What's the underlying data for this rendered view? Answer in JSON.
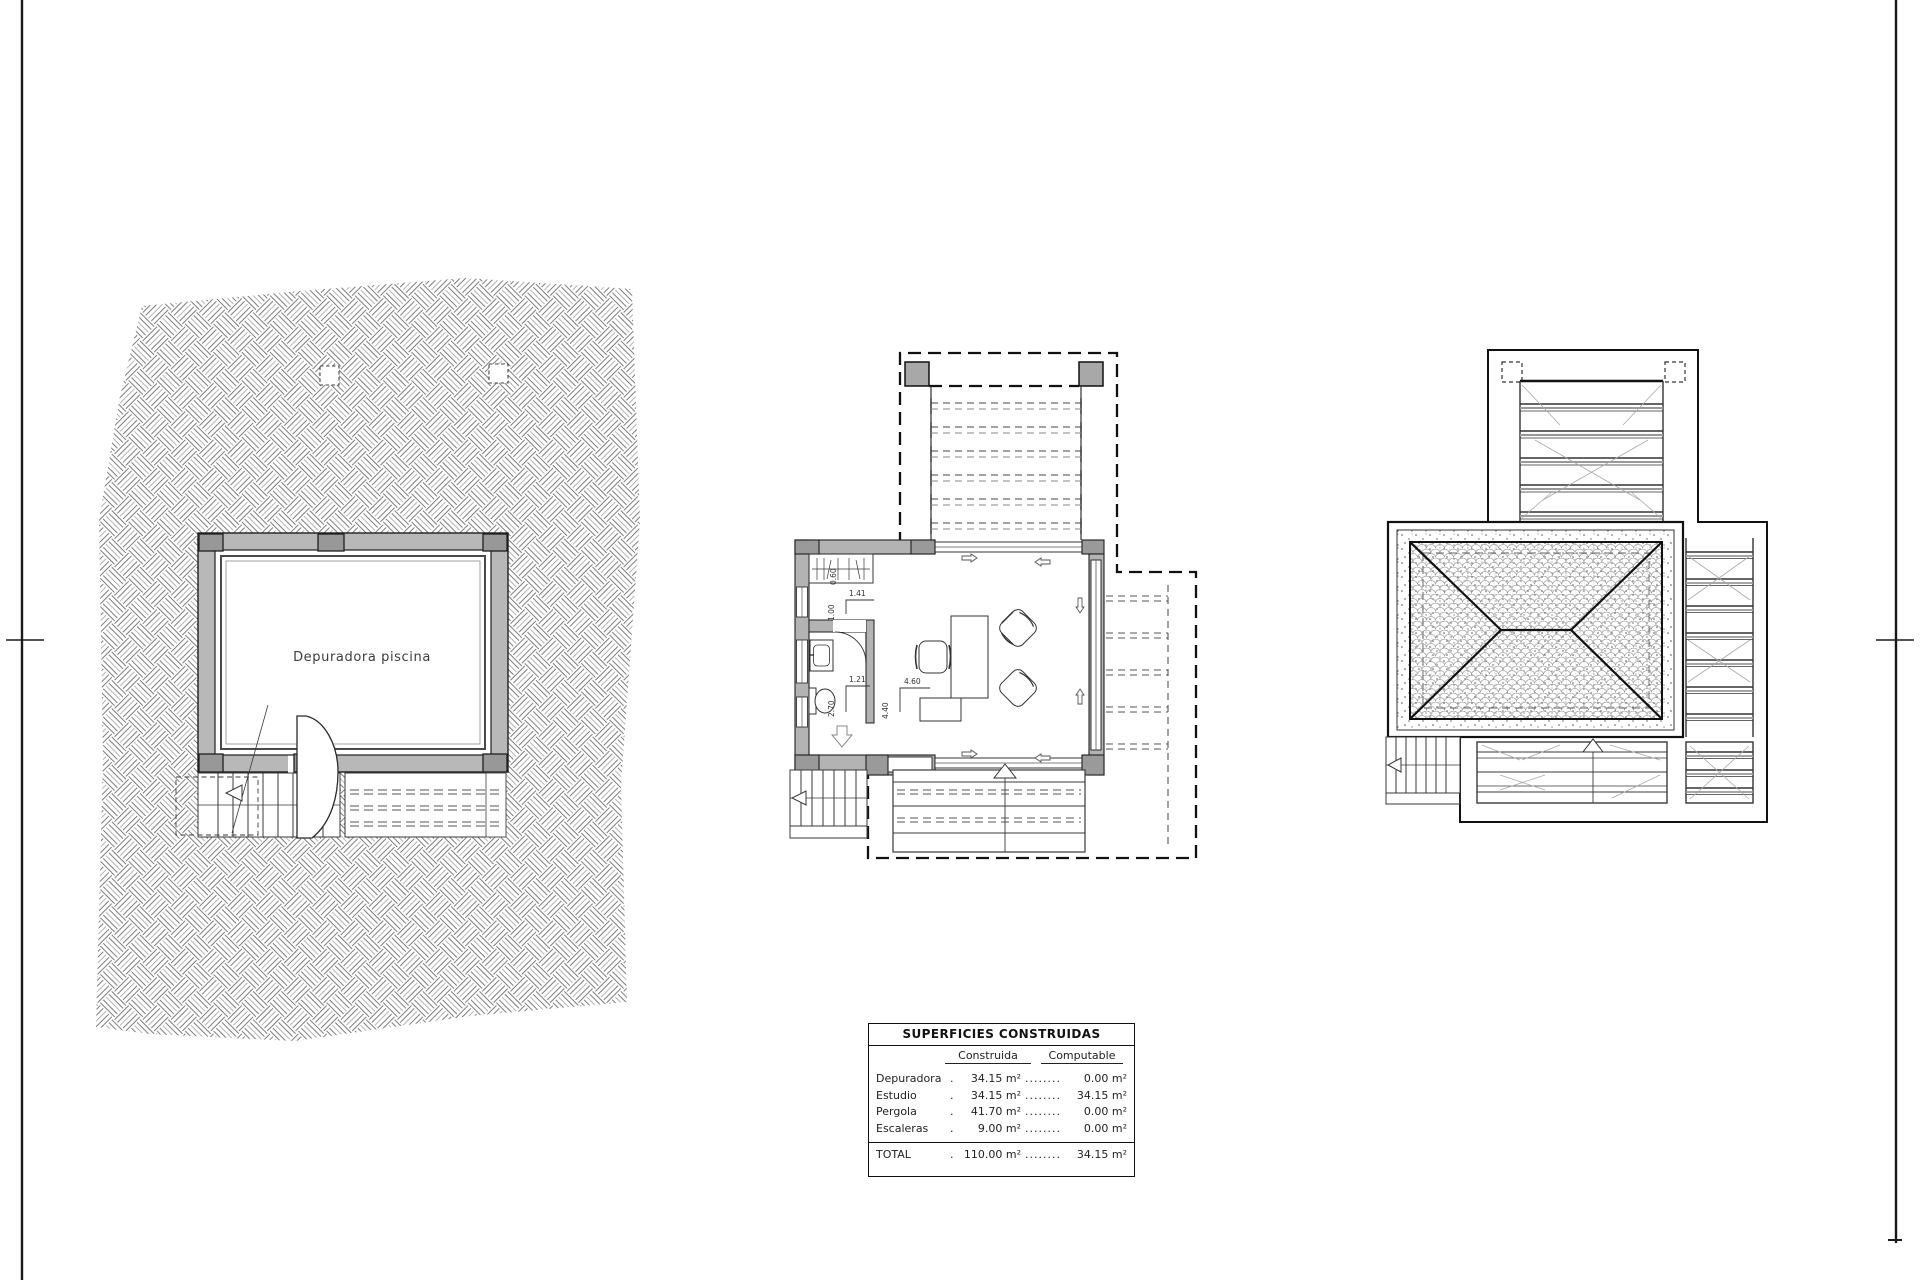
{
  "drawing": {
    "site_plan": {
      "room_label": "Depuradora piscina"
    },
    "studio_plan": {
      "dim_closet_width": "0.60",
      "dim_entry_width": "1.41",
      "dim_entry_depth": "1.00",
      "dim_bath_width": "1.21",
      "dim_bath_depth": "2.70",
      "dim_room_width": "4.60",
      "dim_room_depth": "4.40"
    }
  },
  "areas_table": {
    "title": "SUPERFICIES CONSTRUIDAS",
    "columns": [
      "Construida",
      "Computable"
    ],
    "rows": [
      {
        "label": "Depuradora",
        "leader1": "............",
        "constructed": "34.15 m²",
        "leader2": "........",
        "computable": "0.00 m²"
      },
      {
        "label": "Estudio",
        "leader1": "............",
        "constructed": "34.15 m²",
        "leader2": "........",
        "computable": "34.15 m²"
      },
      {
        "label": "Pergola",
        "leader1": "............",
        "constructed": "41.70 m²",
        "leader2": "........",
        "computable": "0.00 m²"
      },
      {
        "label": "Escaleras",
        "leader1": "............",
        "constructed": "9.00 m²",
        "leader2": "........",
        "computable": "0.00 m²"
      }
    ],
    "total": {
      "label": "TOTAL",
      "leader1": "............",
      "constructed": "110.00 m²",
      "leader2": "........",
      "computable": "34.15 m²"
    }
  }
}
